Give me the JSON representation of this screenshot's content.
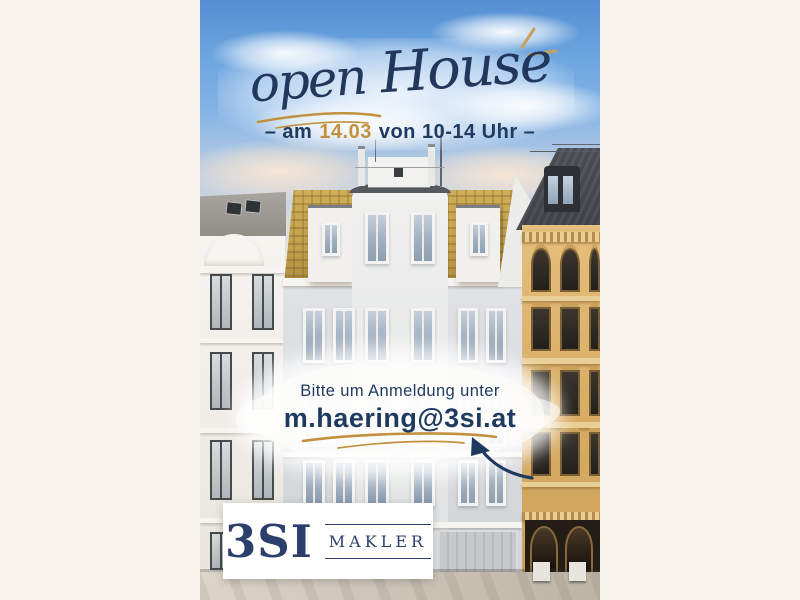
{
  "poster": {
    "headline": {
      "open": "open",
      "house": "House"
    },
    "event_line": {
      "pre": "– am",
      "date": "14.03",
      "post": "von 10-14 Uhr –"
    },
    "contact": {
      "intro": "Bitte um Anmeldung unter",
      "email": "m.haering@3si.at"
    },
    "logo": {
      "brand": "3SI",
      "division": "MAKLER"
    },
    "icons": {
      "headline_underline": "gold-underline-swoosh-icon",
      "sparkles": "sparkle-strokes-icon",
      "email_underline": "gold-underline-swoosh-icon",
      "arrow": "curved-arrow-icon"
    },
    "colors": {
      "navy": "#1e3a5f",
      "gold": "#c2913f",
      "cream": "#f8f4ec",
      "sky_top": "#558fd3"
    }
  }
}
